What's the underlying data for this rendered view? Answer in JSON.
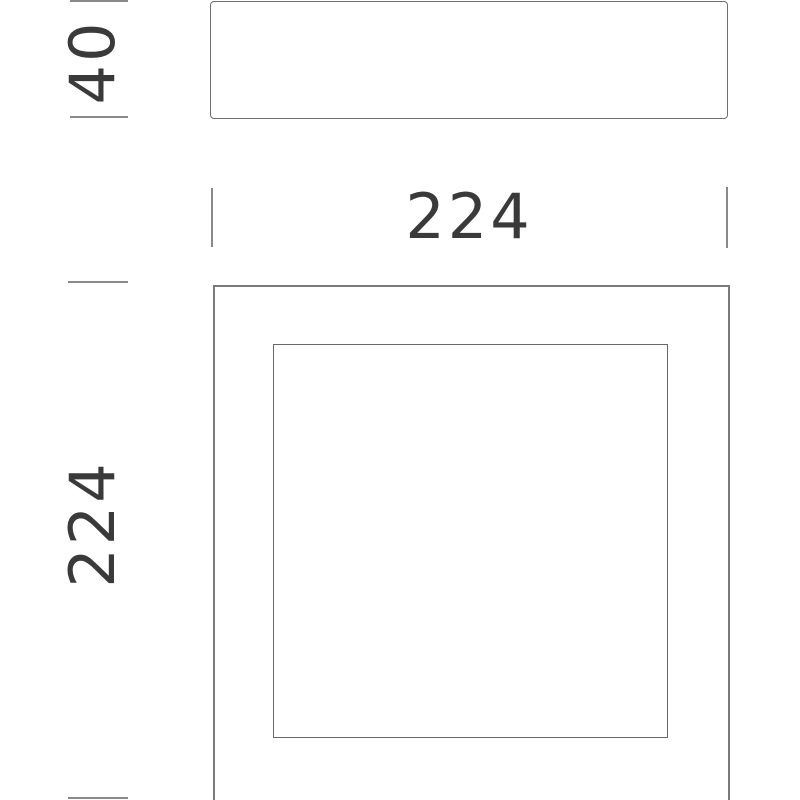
{
  "drawing": {
    "type": "product-dimension-diagram",
    "views": {
      "side": {
        "name": "side-profile-view",
        "depth_dimension": "40"
      },
      "front": {
        "name": "front-face-view",
        "width_dimension": "224",
        "height_dimension": "224"
      }
    },
    "units": "mm",
    "colors": {
      "background": "#ffffff",
      "outline": "#6f6f6f",
      "outline_front": "#7b7b7b",
      "tick": "#8a8a8a",
      "dimension_text": "#3a3a3a"
    }
  }
}
